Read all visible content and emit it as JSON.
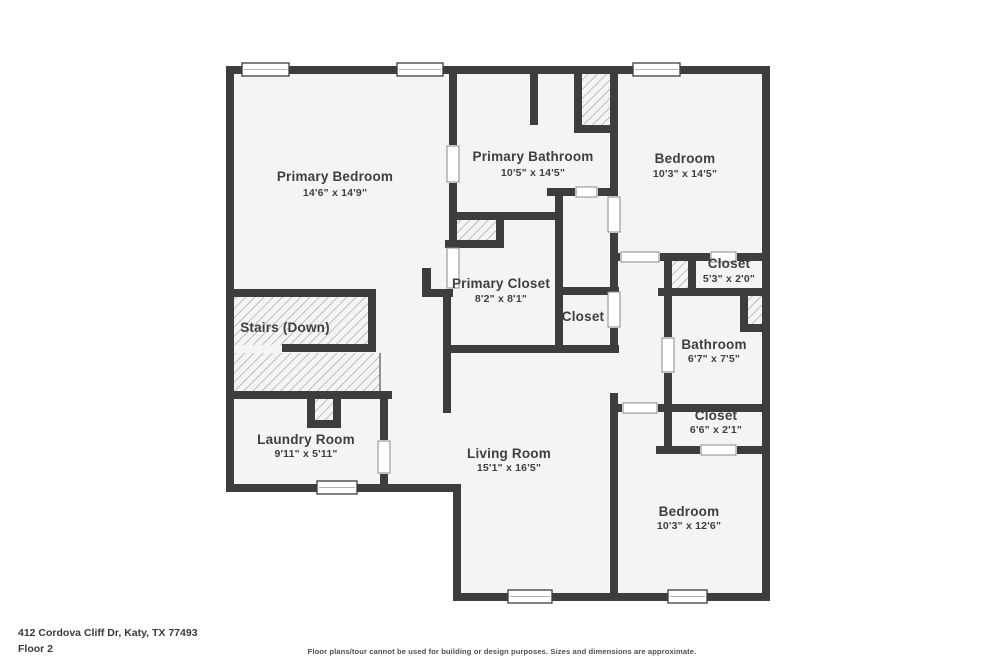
{
  "plan": {
    "rooms": [
      {
        "name": "Primary Bedroom",
        "dims": "14'6\" x 14'9\""
      },
      {
        "name": "Primary Bathroom",
        "dims": "10'5\" x 14'5\""
      },
      {
        "name": "Bedroom",
        "dims": "10'3\" x 14'5\""
      },
      {
        "name": "Closet",
        "dims": "5'3\" x 2'0\""
      },
      {
        "name": "Primary Closet",
        "dims": "8'2\" x 8'1\""
      },
      {
        "name": "Closet",
        "dims": ""
      },
      {
        "name": "Bathroom",
        "dims": "6'7\" x 7'5\""
      },
      {
        "name": "Stairs (Down)",
        "dims": ""
      },
      {
        "name": "Closet",
        "dims": "6'6\" x 2'1\""
      },
      {
        "name": "Laundry Room",
        "dims": "9'11\" x 5'11\""
      },
      {
        "name": "Living Room",
        "dims": "15'1\" x 16'5\""
      },
      {
        "name": "Bedroom",
        "dims": "10'3\" x 12'6\""
      }
    ]
  },
  "footer": {
    "address": "412 Cordova Cliff Dr, Katy, TX 77493",
    "floor": "Floor 2",
    "disclaimer": "Floor plans/tour cannot be used for building or design purposes. Sizes and dimensions are approximate."
  },
  "colors": {
    "wall": "#3d3d3d",
    "floor": "#f4f4f4",
    "hatch": "#9a9a9a",
    "ink": "#3f3f3f",
    "page": "#ffffff"
  }
}
